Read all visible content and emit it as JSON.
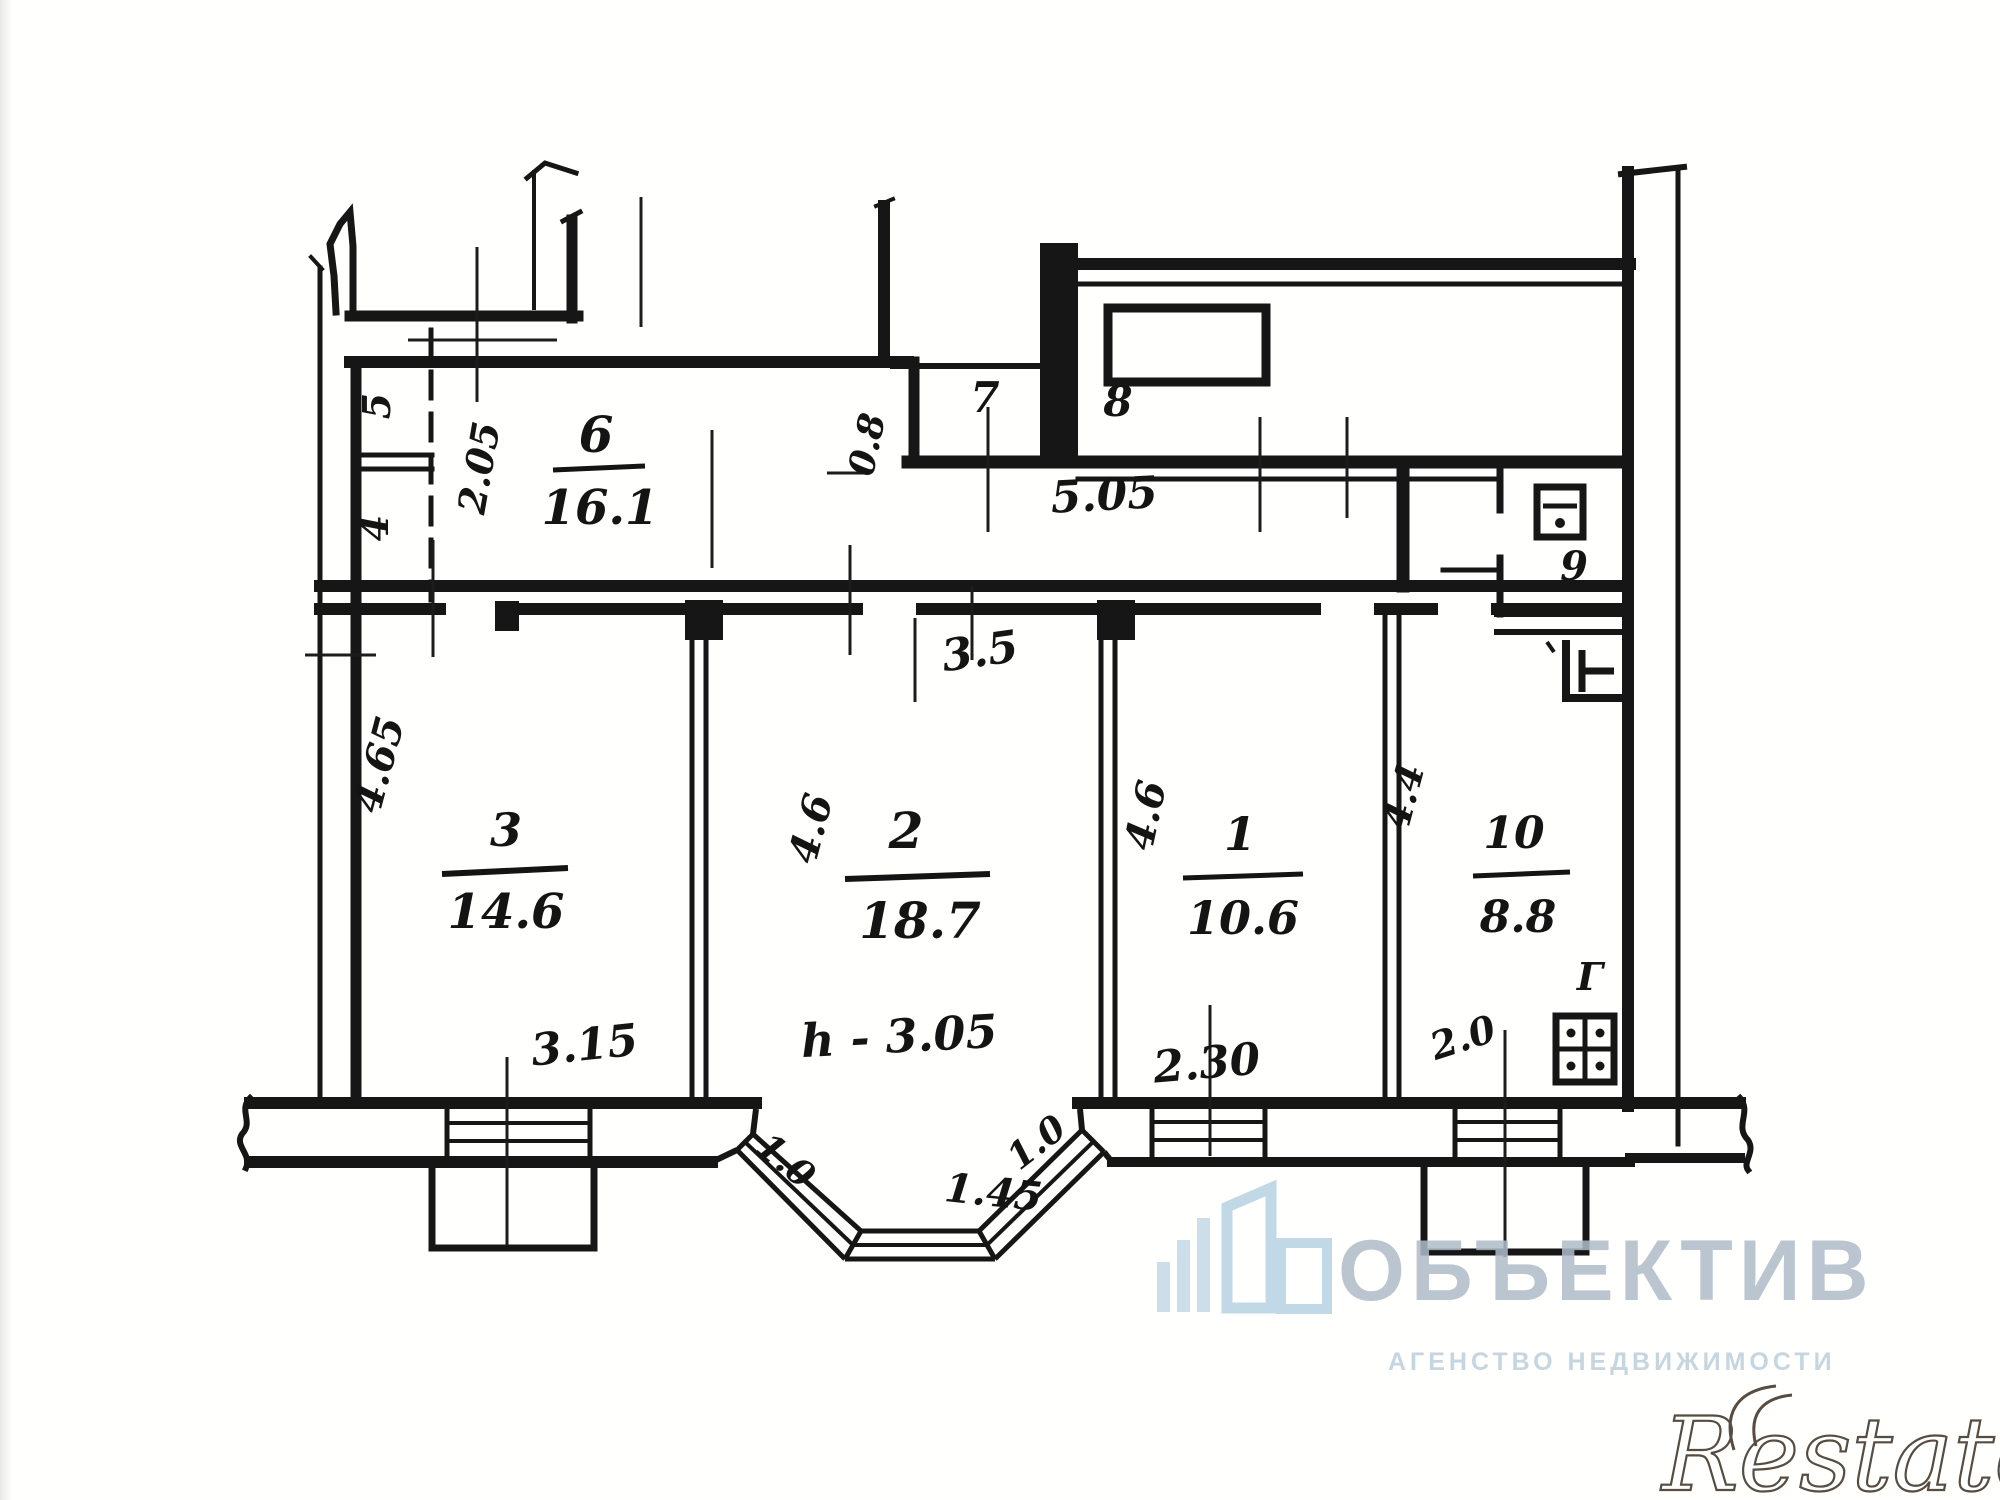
{
  "watermark": {
    "brand": "ОБЪЕКТИВ",
    "tagline": "АГЕНСТВО НЕДВИЖИМОСТИ"
  },
  "corner_logo": {
    "text": "Restate"
  },
  "floorplan": {
    "rooms": {
      "r1": {
        "number": "1",
        "area": "10.6"
      },
      "r2": {
        "number": "2",
        "area": "18.7"
      },
      "r3": {
        "number": "3",
        "area": "14.6"
      },
      "r4": {
        "number": "4"
      },
      "r5": {
        "number": "5"
      },
      "r6": {
        "number": "6",
        "area": "16.1"
      },
      "r7": {
        "number": "7"
      },
      "r8": {
        "number": "8"
      },
      "r9": {
        "number": "9"
      },
      "r10": {
        "number": "10",
        "area": "8.8"
      }
    },
    "dims": {
      "room3_height": "4.65",
      "hall_small": "2.05",
      "closet_width": "0.8",
      "hall_length": "5.05",
      "room2_width": "3.5",
      "room2_height": "4.6",
      "room1_height": "4.6",
      "room10_height": "4.4",
      "room3_width": "3.15",
      "ceiling_height": "h - 3.05",
      "room1_window": "2.30",
      "room10_window": "2.0",
      "bay_left": "1.0",
      "bay_center": "1.45",
      "bay_right": "1.0",
      "gas_mark": "Г"
    }
  }
}
